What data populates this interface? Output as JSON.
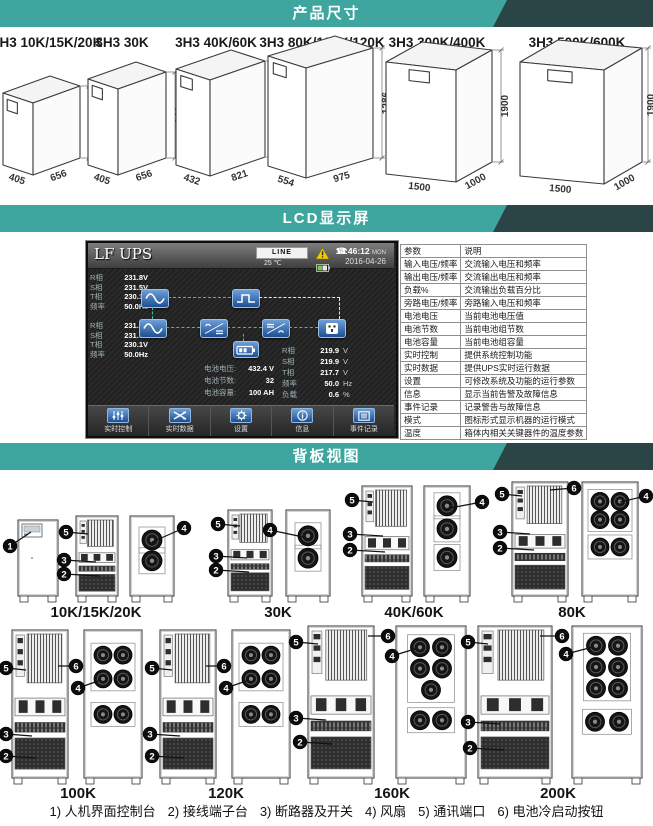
{
  "colors": {
    "teal": "#3ea69f",
    "dark_slate": "#2b4546",
    "icon_blue": "#1c4f94",
    "flow_teal": "#46b8a4",
    "warn_yellow": "#f3c800"
  },
  "sections": {
    "dimensions": {
      "header": "产品尺寸",
      "models": [
        {
          "label": "3H3 10K/15K/20K",
          "width": "405",
          "depth": "656",
          "height": "817"
        },
        {
          "label": "3H3 30K",
          "width": "405",
          "depth": "656",
          "height": "941"
        },
        {
          "label": "3H3 40K/60K",
          "width": "432",
          "depth": "821",
          "height": "1159"
        },
        {
          "label": "3H3 80K/100K/120K",
          "width": "554",
          "depth": "975",
          "height": "1286"
        },
        {
          "label": "3H3 300K/400K",
          "width": "1500",
          "depth": "1000",
          "height": "1900"
        },
        {
          "label": "3H3 500K/600K",
          "width": "1500",
          "depth": "1000",
          "height": "1900"
        }
      ]
    },
    "lcd": {
      "header": "LCD显示屏",
      "screen": {
        "title": "LF UPS",
        "status": {
          "line": "LINE",
          "temp": "25 ℃",
          "time": "14:46:12",
          "time_suffix": "MON",
          "date": "2016-04-26"
        },
        "icons": {
          "phone": "☎"
        },
        "input1": [
          [
            "R相",
            "231.8V"
          ],
          [
            "S相",
            "231.5V"
          ],
          [
            "T相",
            "230.1V"
          ],
          [
            "频率",
            "50.0Hz"
          ]
        ],
        "input2": [
          [
            "R相",
            "231.8V"
          ],
          [
            "S相",
            "231.5V"
          ],
          [
            "T相",
            "230.1V"
          ],
          [
            "频率",
            "50.0Hz"
          ]
        ],
        "battery": [
          [
            "电池电压:",
            "432.4 V"
          ],
          [
            "电池节数:",
            "32"
          ],
          [
            "电池容量:",
            "100 AH"
          ]
        ],
        "output": [
          [
            "R相",
            "219.9",
            "V"
          ],
          [
            "S相",
            "219.9",
            "V"
          ],
          [
            "T相",
            "217.7",
            "V"
          ],
          [
            "频率",
            "50.0",
            "Hz"
          ],
          [
            "负载",
            "0.6",
            "%"
          ]
        ],
        "buttons": [
          "实时控制",
          "实时数据",
          "设置",
          "信息",
          "事件记录"
        ]
      },
      "table": {
        "headers": [
          "参数",
          "说明"
        ],
        "rows": [
          [
            "输入电压/频率",
            "交流输入电压和频率"
          ],
          [
            "输出电压/频率",
            "交流输出电压和频率"
          ],
          [
            "负载%",
            "交流输出负载百分比"
          ],
          [
            "旁路电压/频率",
            "旁路输入电压和频率"
          ],
          [
            "电池电压",
            "当前电池电压值"
          ],
          [
            "电池节数",
            "当前电池组节数"
          ],
          [
            "电池容量",
            "当前电池组容量"
          ],
          [
            "实时控制",
            "提供系统控制功能"
          ],
          [
            "实时数据",
            "提供UPS实时运行数据"
          ],
          [
            "设置",
            "可修改系统及功能的运行参数"
          ],
          [
            "信息",
            "显示当前告警及故障信息"
          ],
          [
            "事件记录",
            "记录警告与故障信息"
          ],
          [
            "模式",
            "图标形式显示机器的运行模式"
          ],
          [
            "温度",
            "箱体内相关关键器件的温度参数"
          ]
        ]
      }
    },
    "rear": {
      "header": "背板视图",
      "groups": [
        {
          "label": "10K/15K/20K",
          "units": [
            "front",
            "rear",
            "fans2"
          ],
          "callouts": [
            "1",
            "5",
            "3",
            "2",
            "4"
          ]
        },
        {
          "label": "30K",
          "units": [
            "rear",
            "fans2"
          ],
          "callouts": [
            "5",
            "3",
            "2",
            "4"
          ]
        },
        {
          "label": "40K/60K",
          "units": [
            "rear",
            "fans3"
          ],
          "callouts": [
            "5",
            "3",
            "2",
            "4"
          ]
        },
        {
          "label": "80K",
          "units": [
            "rear",
            "fans6"
          ],
          "callouts": [
            "6",
            "5",
            "3",
            "2",
            "4"
          ]
        },
        {
          "label": "100K",
          "units": [
            "rear",
            "fans6"
          ],
          "callouts": [
            "5",
            "6",
            "3",
            "2",
            "4"
          ]
        },
        {
          "label": "120K",
          "units": [
            "rear",
            "fans6"
          ],
          "callouts": [
            "5",
            "6",
            "3",
            "2",
            "4"
          ]
        },
        {
          "label": "160K",
          "units": [
            "rear",
            "fans7"
          ],
          "callouts": [
            "5",
            "6",
            "3",
            "2",
            "4"
          ]
        },
        {
          "label": "200K",
          "units": [
            "rear",
            "fans8"
          ],
          "callouts": [
            "5",
            "6",
            "3",
            "2",
            "4"
          ]
        }
      ],
      "legend": [
        "1) 人机界面控制台",
        "2) 接线端子台",
        "3) 断路器及开关",
        "4) 风扇",
        "5) 通讯端口",
        "6) 电池冷启动按钮"
      ]
    }
  }
}
